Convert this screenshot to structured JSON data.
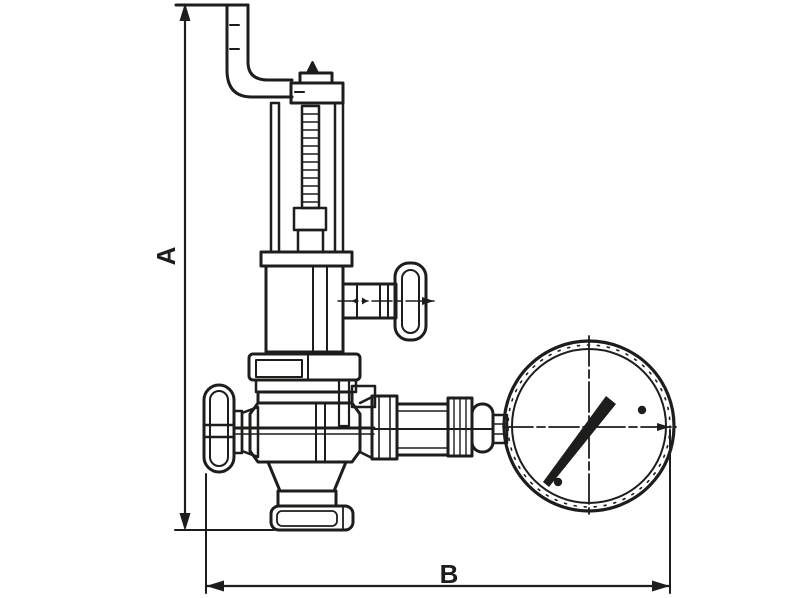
{
  "drawing": {
    "background": "#ffffff",
    "line_color": "#1d1d1b",
    "dimensions": {
      "vertical_label": "A",
      "horizontal_label": "B"
    }
  }
}
